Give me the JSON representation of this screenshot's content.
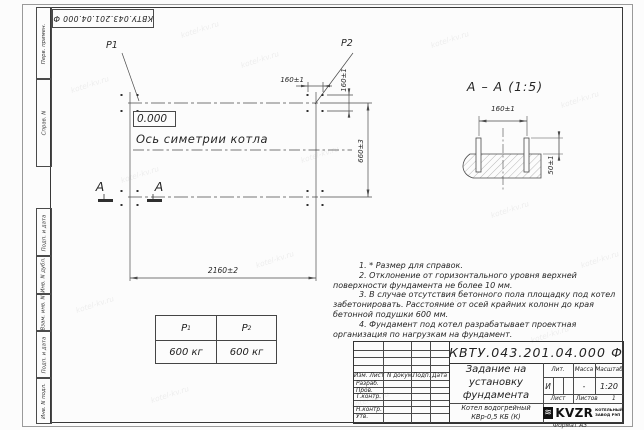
{
  "doc_number": "КВТУ.043.201.04.000 Ф",
  "watermark": "kotel-kv.ru",
  "margin_labels": [
    "Перв. примен.",
    "Справ. N",
    "Подп. и дата",
    "Инв. N дубл.",
    "Взам. инв. N",
    "Подп. и дата",
    "Инв. N подл."
  ],
  "plan": {
    "p1": "P1",
    "p2": "P2",
    "elevation": "0.000",
    "symmetry_axis_label": "Ось симетрии котла",
    "section_letter": "A",
    "dim_bolt_spacing_top": "160±1",
    "dim_bolt_spacing_side": "160±1",
    "dim_length": "2160±2",
    "dim_width": "660±3"
  },
  "section_view": {
    "title": "А – А (1:5)",
    "dim_bolt_spacing": "160±1",
    "dim_bolt_height": "50±1"
  },
  "notes": [
    "1. * Размер для справок.",
    "2. Отклонение от горизонтального уровня верхней поверхности фундамента не более 10 мм.",
    "3. В случае отсутствия бетонного пола площадку под котел забетонировать. Расстояние от осей крайних колонн до края бетонной подушки 600 мм.",
    "4. Фундамент под котел разрабатывает проектная организация по нагрузкам на фундамент."
  ],
  "load_table": {
    "headers": [
      {
        "base": "P",
        "sub": "1"
      },
      {
        "base": "P",
        "sub": "2"
      }
    ],
    "values": [
      "600 кг",
      "600 кг"
    ]
  },
  "title_block": {
    "header_cols": [
      "Изм. Лист",
      "N докум.",
      "Подп.",
      "Дата"
    ],
    "sign_rows": [
      "Разраб.",
      "Пров.",
      "Т.контр.",
      "",
      "Н.контр.",
      "Утв."
    ],
    "title_lines": [
      "Задание на",
      "установку",
      "фундамента"
    ],
    "product_lines": [
      "Котел водогрейный",
      "КВр-0,5 КБ (К)"
    ],
    "lit_header": "Лит.",
    "mass_header": "Масса",
    "scale_header": "Масштаб",
    "lit_value": "И",
    "mass_value": "-",
    "scale_value": "1:20",
    "sheet_label": "Лист",
    "sheets_label": "Листов",
    "sheets_value": "1",
    "logo_text": "KVZR",
    "logo_lines": [
      "КОТЕЛЬНЫЙ",
      "ЗАВОД РЭП"
    ],
    "format_label": "Формат А3"
  }
}
